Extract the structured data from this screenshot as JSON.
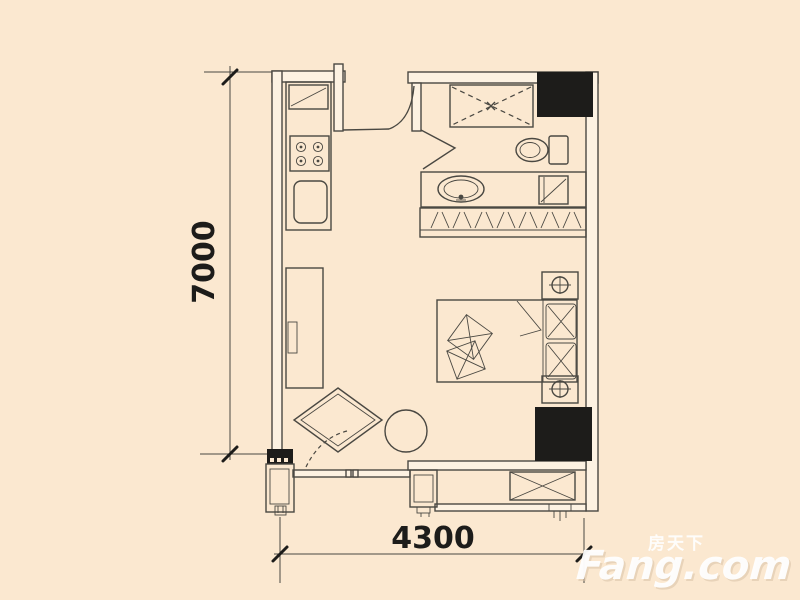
{
  "title": "studio-apartment-floor-plan",
  "colors": {
    "bg": "#fbe8d0",
    "line": "#4a4842",
    "black": "#1d1c1a",
    "wallfill": "#fdf2e2",
    "wm": "#ffffff",
    "wmshadow": "#d9c3a8"
  },
  "dimensions": {
    "height_label": "7000",
    "width_label": "4300"
  },
  "watermark": {
    "cn": "房天下",
    "en": "Fang.com"
  }
}
